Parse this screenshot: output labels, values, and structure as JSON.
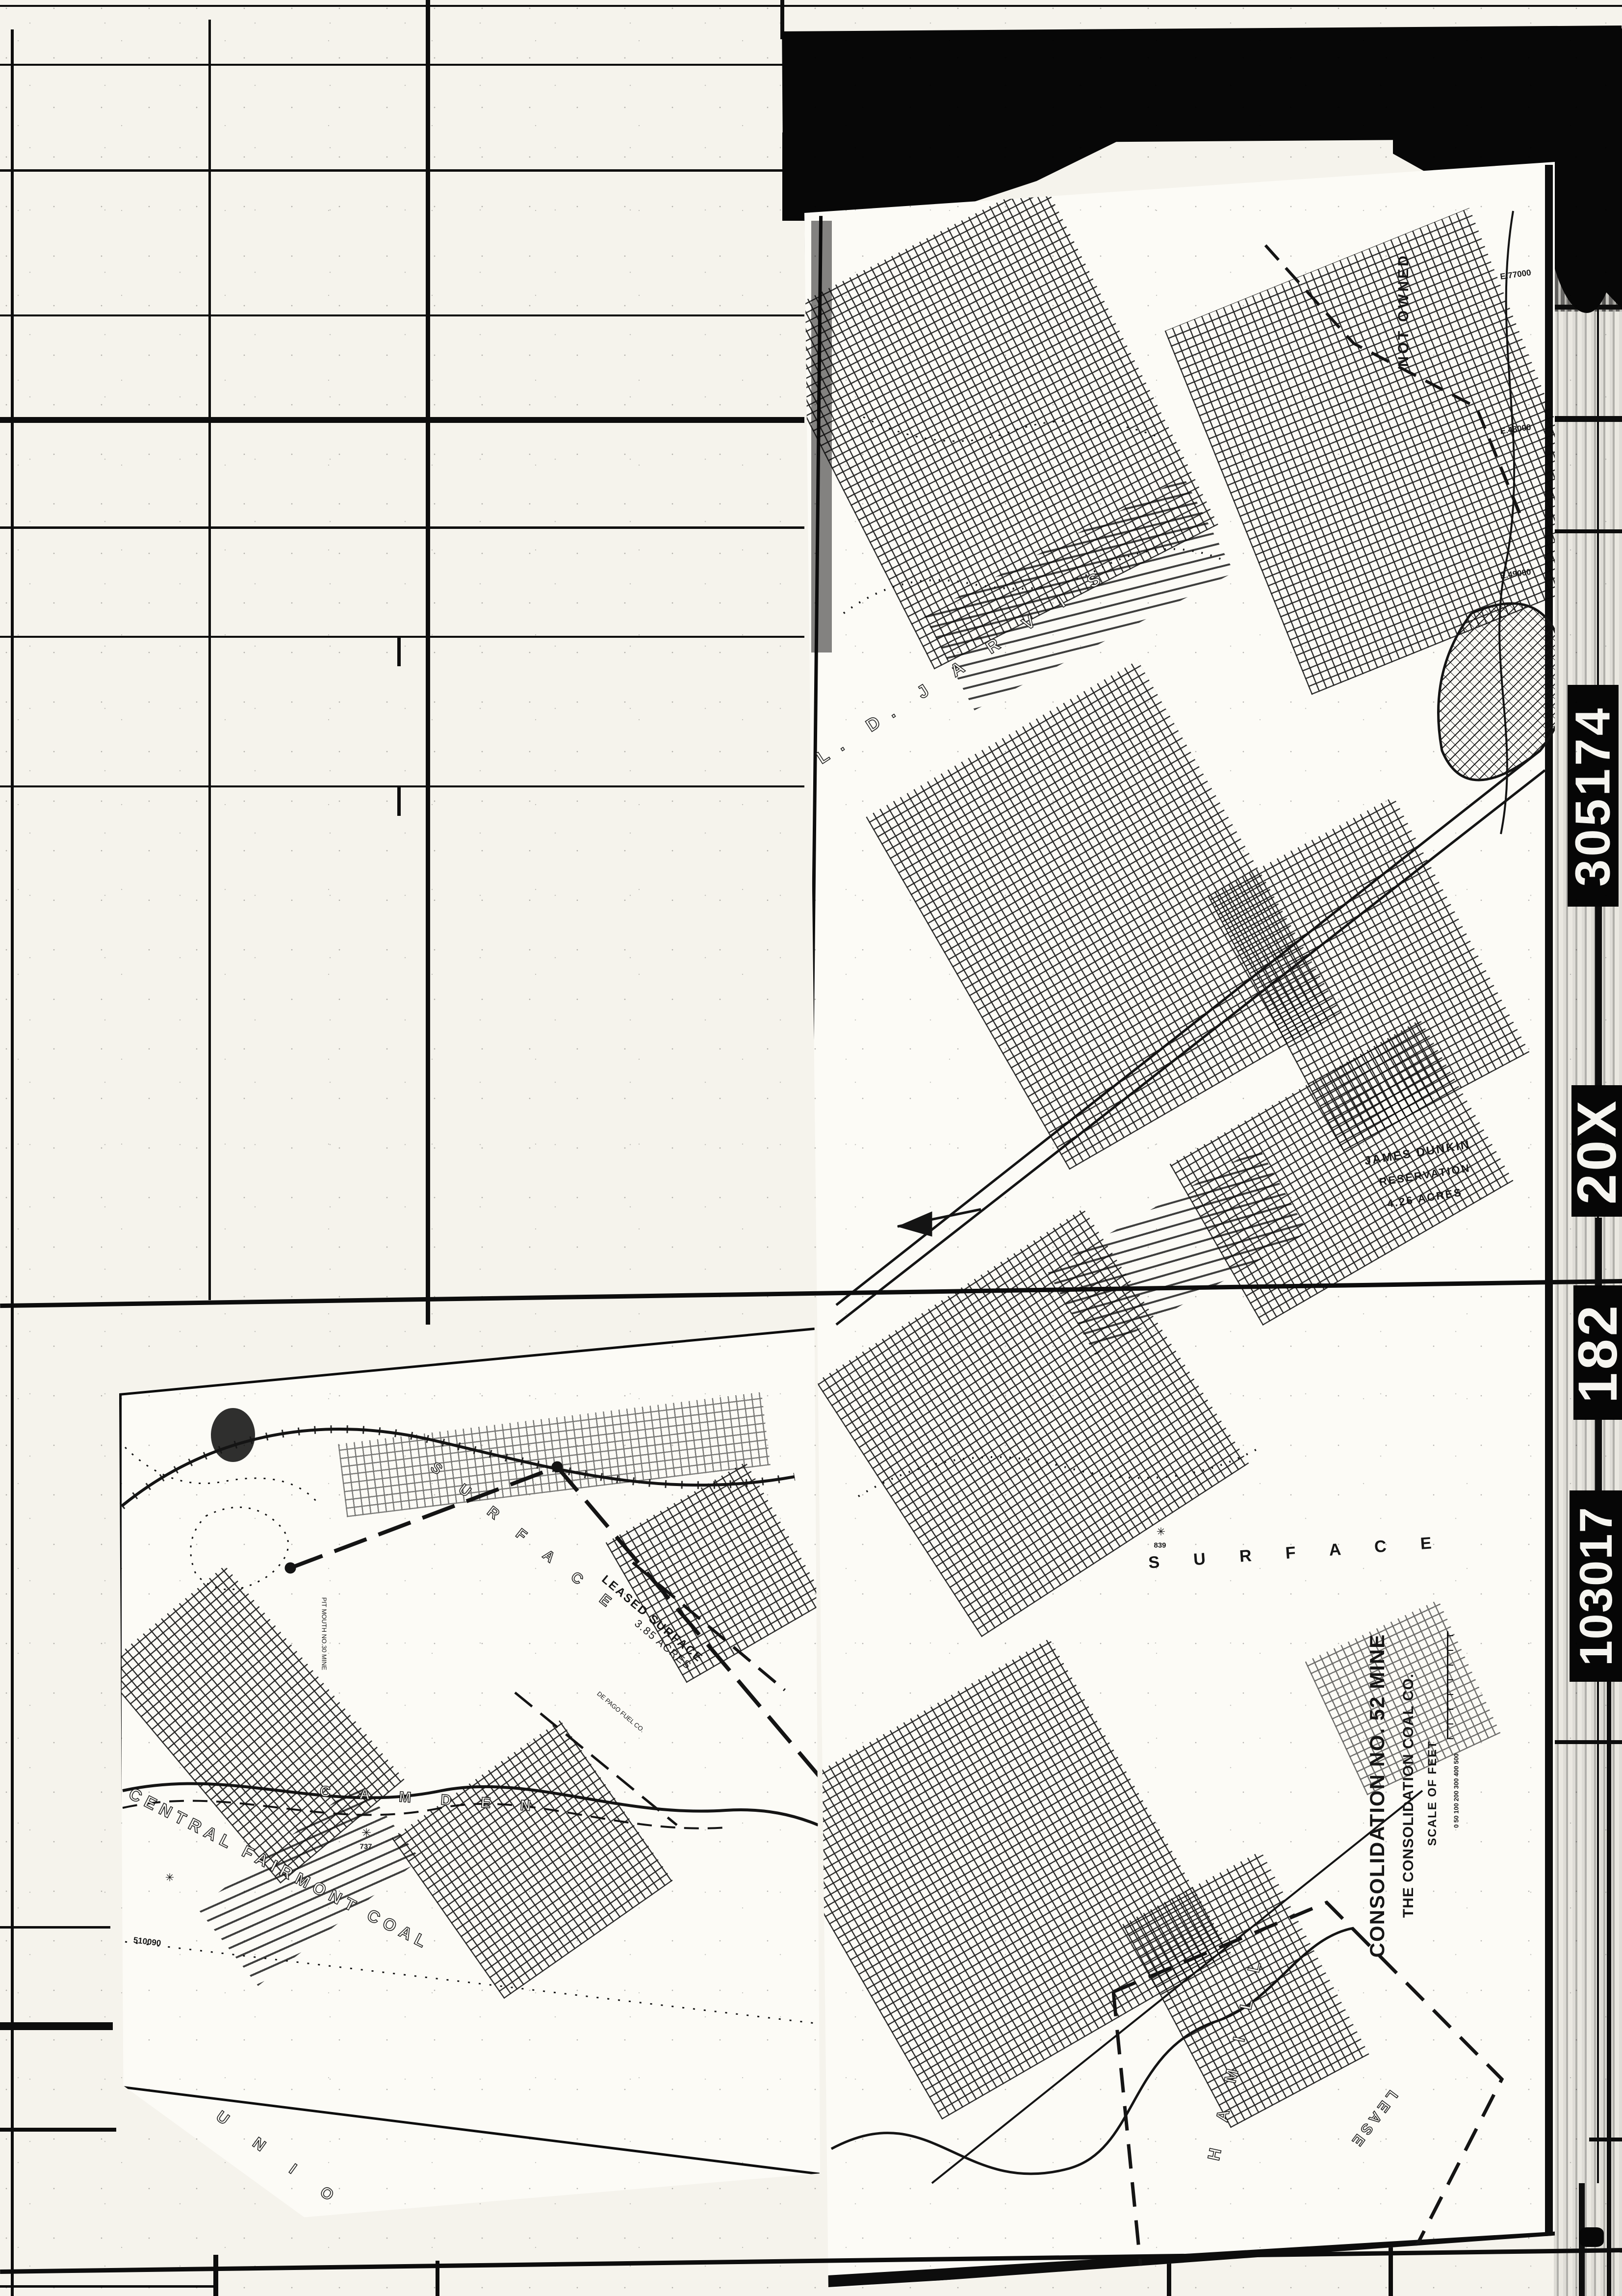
{
  "film": {
    "edge_codes": [
      "305174",
      "20X",
      "182",
      "103017"
    ]
  },
  "sheet_a": {
    "title_block": {
      "title": "CONSOLIDATION NO. 52 MINE",
      "company": "THE CONSOLIDATION COAL CO.",
      "scale_label": "SCALE OF FEET",
      "scale_ticks": "0 50 100  200  300  400  500"
    },
    "labels": {
      "not_owned": "NOT OWNED",
      "jarvis": "L. D. J A R V I S",
      "reservation_owner": "JAMES DUNKIN",
      "reservation_word": "RESERVATION",
      "reservation_acres": "4.26 ACRES",
      "surface": "S U R F A C E",
      "lease": "LEASE",
      "hamill": "H A M I L L",
      "benchmark": "839"
    },
    "coordinates": [
      "E.77000",
      "E.48000",
      "E.49000"
    ]
  },
  "sheet_b": {
    "labels": {
      "camden": "C A M D E N",
      "central_fairmont": "CENTRAL FAIRMONT COAL",
      "union": "U N I O N",
      "surface": "S U R F A C E",
      "leased_surface": "LEASED SURFACE",
      "leased_acres": "3.85 ACRES",
      "pit_mouth": "PIT MOUTH NO.30 MINE",
      "fuel_co": "DE PAGO FUEL CO.",
      "coordinate": "510090",
      "elevation": "737"
    }
  },
  "icons": {
    "shaft_symbol": "✳"
  }
}
